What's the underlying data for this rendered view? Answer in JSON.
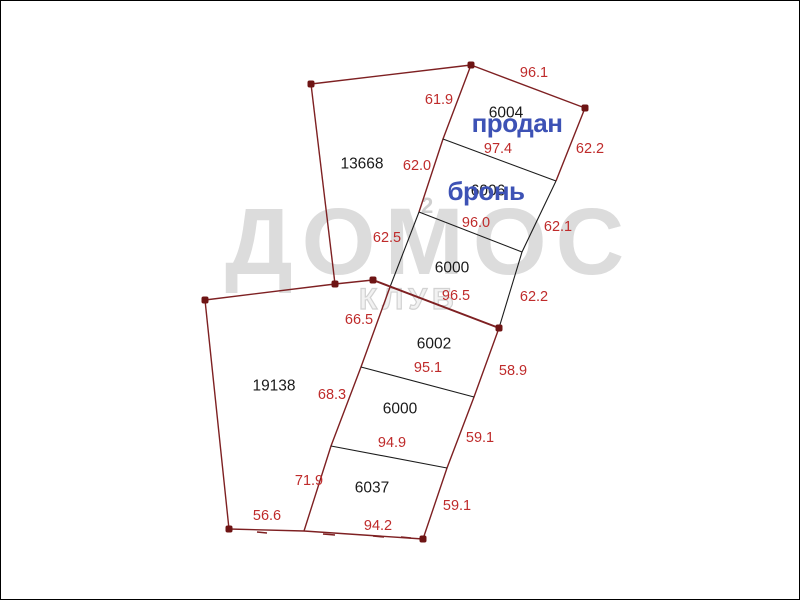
{
  "watermark": {
    "word": "ДОМОС",
    "subword": "КЛУБ",
    "superscript": "2"
  },
  "colors": {
    "boundary_line": "#7e2022",
    "divider_line": "#1c1c1c",
    "vertex_dot": "#6e1414",
    "measurement_red": "#bf2b2b",
    "plot_number_black": "#1a1a1a",
    "status_blue": "#3d52b5",
    "watermark_gray": "#dcdcdc"
  },
  "labels": [
    {
      "id": "961",
      "text": "96.1",
      "kind": "measurement"
    },
    {
      "id": "619",
      "text": "61.9",
      "kind": "measurement"
    },
    {
      "id": "622a",
      "text": "62.2",
      "kind": "measurement"
    },
    {
      "id": "974",
      "text": "97.4",
      "kind": "measurement"
    },
    {
      "id": "620",
      "text": "62.0",
      "kind": "measurement"
    },
    {
      "id": "960",
      "text": "96.0",
      "kind": "measurement"
    },
    {
      "id": "621",
      "text": "62.1",
      "kind": "measurement"
    },
    {
      "id": "625",
      "text": "62.5",
      "kind": "measurement"
    },
    {
      "id": "965",
      "text": "96.5",
      "kind": "measurement"
    },
    {
      "id": "622b",
      "text": "62.2",
      "kind": "measurement"
    },
    {
      "id": "665",
      "text": "66.5",
      "kind": "measurement"
    },
    {
      "id": "951",
      "text": "95.1",
      "kind": "measurement"
    },
    {
      "id": "589",
      "text": "58.9",
      "kind": "measurement"
    },
    {
      "id": "683",
      "text": "68.3",
      "kind": "measurement"
    },
    {
      "id": "949",
      "text": "94.9",
      "kind": "measurement"
    },
    {
      "id": "591a",
      "text": "59.1",
      "kind": "measurement"
    },
    {
      "id": "719",
      "text": "71.9",
      "kind": "measurement"
    },
    {
      "id": "591b",
      "text": "59.1",
      "kind": "measurement"
    },
    {
      "id": "566",
      "text": "56.6",
      "kind": "measurement"
    },
    {
      "id": "942",
      "text": "94.2",
      "kind": "measurement"
    },
    {
      "id": "13668",
      "text": "13668",
      "kind": "plot"
    },
    {
      "id": "6004",
      "text": "6004",
      "kind": "plot"
    },
    {
      "id": "6006",
      "text": "6006",
      "kind": "plot"
    },
    {
      "id": "6000a",
      "text": "6000",
      "kind": "plot"
    },
    {
      "id": "6002",
      "text": "6002",
      "kind": "plot"
    },
    {
      "id": "6000b",
      "text": "6000",
      "kind": "plot"
    },
    {
      "id": "6037",
      "text": "6037",
      "kind": "plot"
    },
    {
      "id": "19138",
      "text": "19138",
      "kind": "plot"
    },
    {
      "id": "prodan",
      "text": "продан",
      "kind": "status"
    },
    {
      "id": "bron",
      "text": "бронь",
      "kind": "status"
    }
  ]
}
